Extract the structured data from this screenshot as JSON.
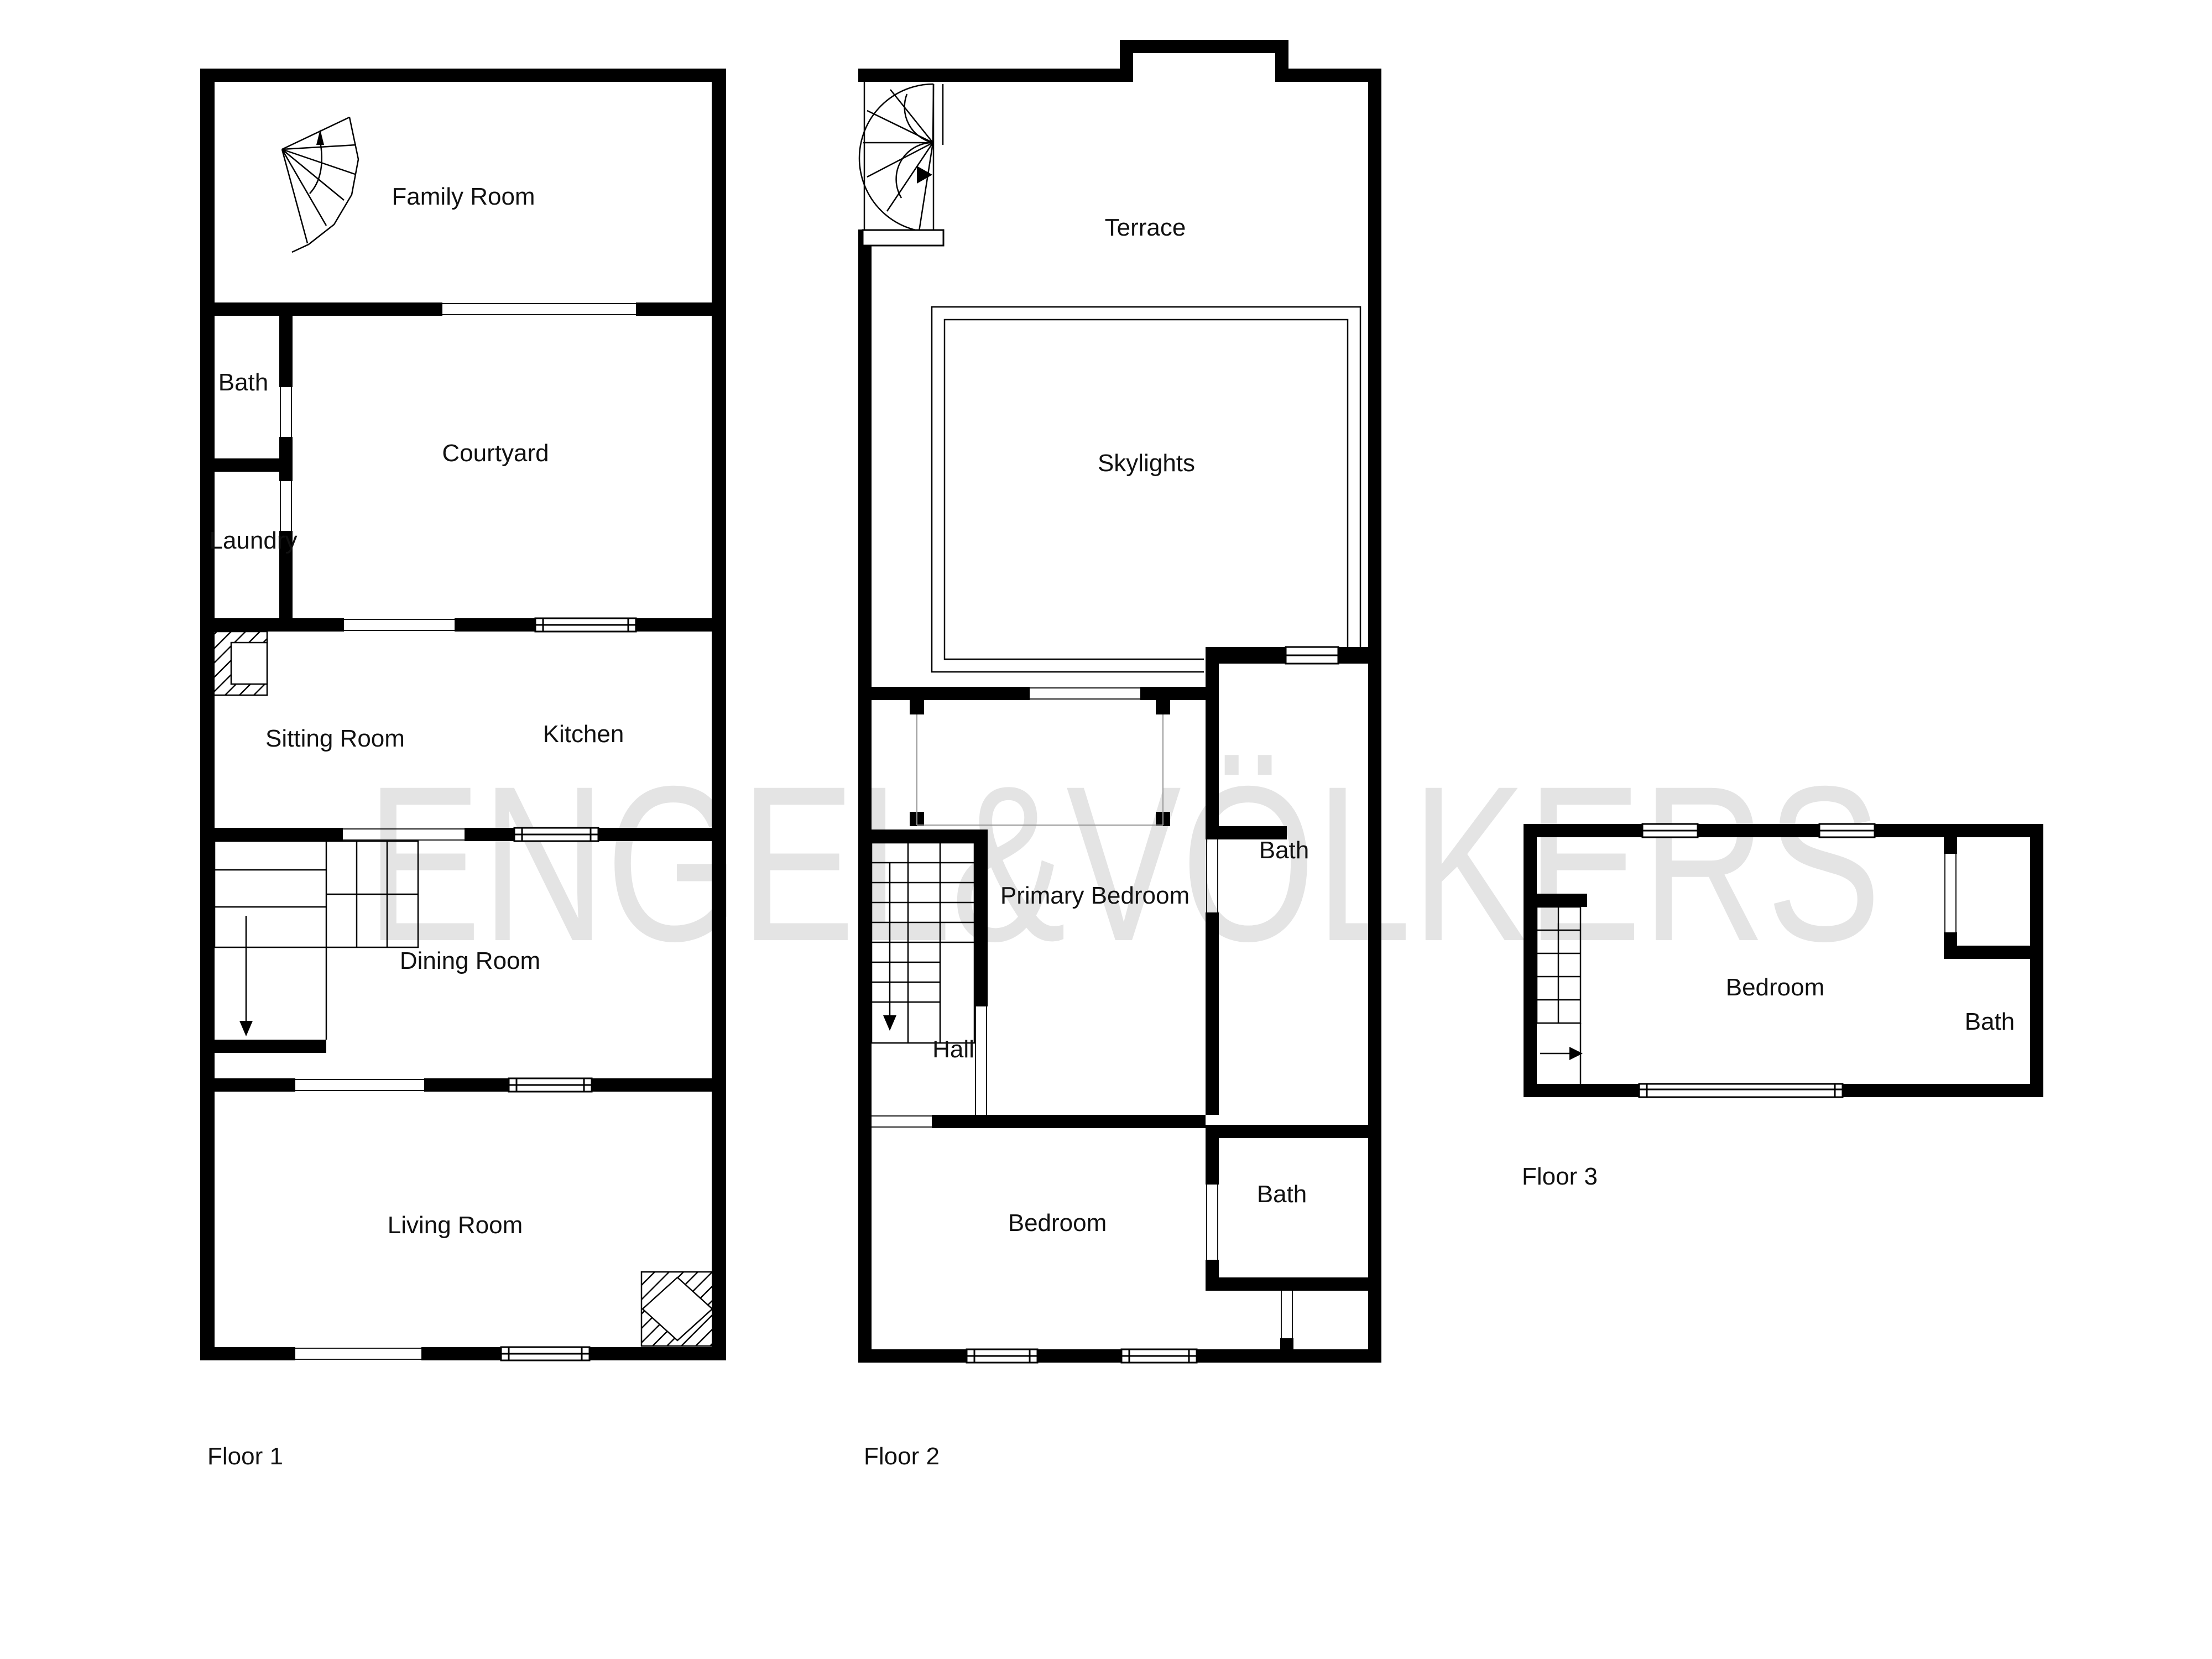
{
  "watermark": {
    "text": "ENGEL&VÖLKERS",
    "color": "#e4e4e4"
  },
  "floors": [
    {
      "name": "Floor 1",
      "rooms": [
        {
          "label": "Family Room"
        },
        {
          "label": "Bath"
        },
        {
          "label": "Courtyard"
        },
        {
          "label": "Laundry"
        },
        {
          "label": "Sitting Room"
        },
        {
          "label": "Kitchen"
        },
        {
          "label": "Dining Room"
        },
        {
          "label": "Living Room"
        }
      ]
    },
    {
      "name": "Floor 2",
      "rooms": [
        {
          "label": "Terrace"
        },
        {
          "label": "Skylights"
        },
        {
          "label": "Bath"
        },
        {
          "label": "Primary Bedroom"
        },
        {
          "label": "Hall"
        },
        {
          "label": "Bath"
        },
        {
          "label": "Bedroom"
        }
      ]
    },
    {
      "name": "Floor 3",
      "rooms": [
        {
          "label": "Bedroom"
        },
        {
          "label": "Bath"
        }
      ]
    }
  ],
  "icons": [
    {
      "name": "spiral-stair-icon"
    },
    {
      "name": "staircase-icon"
    },
    {
      "name": "fireplace-icon"
    },
    {
      "name": "window-symbol"
    },
    {
      "name": "door-opening-symbol"
    }
  ],
  "colors": {
    "wall": "#000000",
    "label": "#111111",
    "background": "#ffffff",
    "watermark": "#e4e4e4"
  }
}
